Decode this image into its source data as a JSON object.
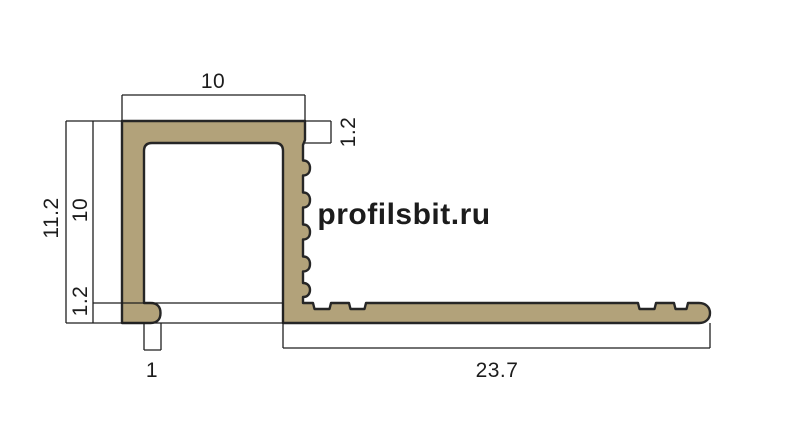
{
  "diagram": {
    "type": "profile-cross-section-drawing",
    "watermark": {
      "text": "profilsbit.ru",
      "color": "#cfe9e6"
    },
    "profile": {
      "fill": "#b2a27a",
      "outline": "#262626"
    },
    "dimension_line_color": "#1f1f1f",
    "dimensions": {
      "top_width": "10",
      "top_wall_thickness": "1.2",
      "total_height": "11.2",
      "inner_height": "10",
      "base_thickness": "1.2",
      "foot_width": "1",
      "base_length": "23.7"
    }
  }
}
